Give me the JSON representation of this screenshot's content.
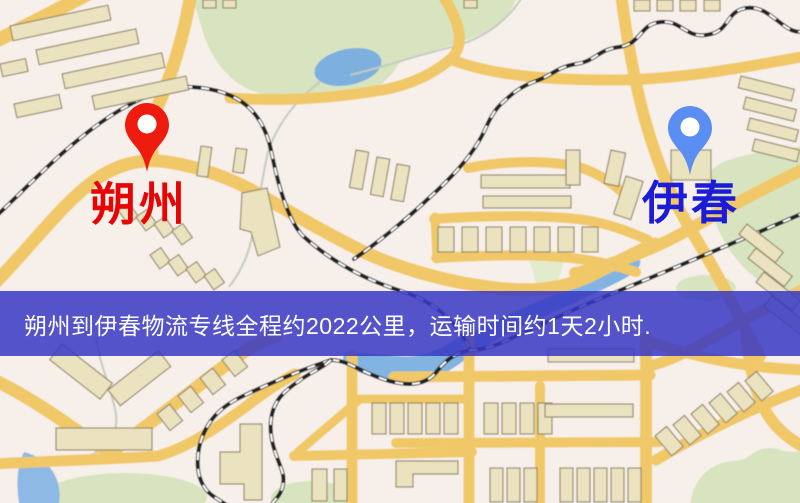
{
  "markers": {
    "origin": {
      "label": "朔州",
      "pin_color": "#ed1c0f",
      "label_color": "#e60404"
    },
    "destination": {
      "label": "伊春",
      "pin_color": "#5b8ef2",
      "label_color": "#1c1cd8"
    }
  },
  "banner": {
    "text": "朔州到伊春物流专线全程约2022公里，运输时间约1天2小时.",
    "route": {
      "from": "朔州",
      "to": "伊春",
      "distance": "约2022公里",
      "duration": "约1天2小时"
    },
    "background_color": "#3737c3",
    "text_color": "#ffffff"
  },
  "map_palette": {
    "background": "#f7f0ea",
    "road_yellow": "#f1c868",
    "park_green": "#d7e4bf",
    "water_blue": "#82b4e2",
    "building_tan": "#ebe2bf",
    "building_outline": "#94896c",
    "railway_black": "#232323"
  }
}
